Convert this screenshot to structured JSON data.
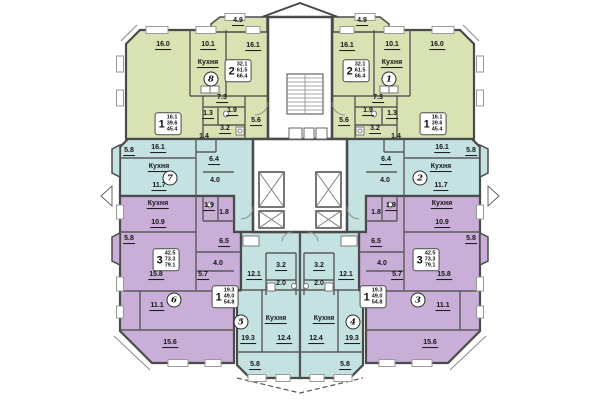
{
  "colors": {
    "apartment_green": "#d8e2b2",
    "apartment_teal": "#c4e2e2",
    "apartment_purple": "#c9aed7",
    "walls": "#4a4a4a",
    "inner_walls": "#5a5a5a",
    "background": "#ffffff"
  },
  "apartments": [
    {
      "number": "8",
      "rooms": "2",
      "living": "32.1",
      "usable": "61.5",
      "total": "66.4",
      "badge_x": 211,
      "badge_y": 79,
      "box_x": 238,
      "box_y": 71
    },
    {
      "number": "1",
      "rooms": "2",
      "living": "32.1",
      "usable": "61.5",
      "total": "66.4",
      "badge_x": 389,
      "badge_y": 79,
      "box_x": 356,
      "box_y": 71
    },
    {
      "number": "7",
      "rooms": "1",
      "living": "16.1",
      "usable": "39.6",
      "total": "45.4",
      "badge_x": 170,
      "badge_y": 178,
      "box_x": 168,
      "box_y": 124
    },
    {
      "number": "2",
      "rooms": "1",
      "living": "16.1",
      "usable": "39.6",
      "total": "45.4",
      "badge_x": 420,
      "badge_y": 178,
      "box_x": 433,
      "box_y": 124
    },
    {
      "number": "6",
      "rooms": "3",
      "living": "42.5",
      "usable": "73.3",
      "total": "79.1",
      "badge_x": 174,
      "badge_y": 300,
      "box_x": 166,
      "box_y": 260
    },
    {
      "number": "3",
      "rooms": "3",
      "living": "42.5",
      "usable": "73.3",
      "total": "79.1",
      "badge_x": 418,
      "badge_y": 300,
      "box_x": 426,
      "box_y": 260
    },
    {
      "number": "5",
      "rooms": "1",
      "living": "19.3",
      "usable": "49.0",
      "total": "54.8",
      "badge_x": 241,
      "badge_y": 322,
      "box_x": 225,
      "box_y": 297
    },
    {
      "number": "4",
      "rooms": "1",
      "living": "19.3",
      "usable": "49.0",
      "total": "54.8",
      "badge_x": 353,
      "badge_y": 322,
      "box_x": 373,
      "box_y": 297
    }
  ],
  "room_labels": [
    {
      "t": "4.9",
      "x": 238,
      "y": 22,
      "u": 1
    },
    {
      "t": "16.0",
      "x": 163,
      "y": 46,
      "u": 1
    },
    {
      "t": "10.1",
      "x": 208,
      "y": 46,
      "u": 1
    },
    {
      "t": "16.1",
      "x": 253,
      "y": 47,
      "u": 1
    },
    {
      "t": "Кухня",
      "x": 208,
      "y": 64,
      "u": 1
    },
    {
      "t": "7.3",
      "x": 222,
      "y": 99,
      "u": 1
    },
    {
      "t": "1.3",
      "x": 208,
      "y": 115,
      "u": 1
    },
    {
      "t": "1.9",
      "x": 232,
      "y": 112,
      "u": 1
    },
    {
      "t": "3.2",
      "x": 225,
      "y": 130,
      "u": 1
    },
    {
      "t": "5.6",
      "x": 256,
      "y": 122,
      "u": 1
    },
    {
      "t": "1.4",
      "x": 204,
      "y": 137,
      "u": 0
    },
    {
      "t": "4.9",
      "x": 362,
      "y": 22,
      "u": 1
    },
    {
      "t": "16.1",
      "x": 347,
      "y": 47,
      "u": 1
    },
    {
      "t": "10.1",
      "x": 392,
      "y": 46,
      "u": 1
    },
    {
      "t": "16.0",
      "x": 437,
      "y": 46,
      "u": 1
    },
    {
      "t": "Кухня",
      "x": 392,
      "y": 64,
      "u": 1
    },
    {
      "t": "7.3",
      "x": 378,
      "y": 99,
      "u": 1
    },
    {
      "t": "1.9",
      "x": 368,
      "y": 112,
      "u": 1
    },
    {
      "t": "1.3",
      "x": 392,
      "y": 115,
      "u": 1
    },
    {
      "t": "3.2",
      "x": 375,
      "y": 130,
      "u": 1
    },
    {
      "t": "5.6",
      "x": 344,
      "y": 122,
      "u": 1
    },
    {
      "t": "1.4",
      "x": 396,
      "y": 137,
      "u": 0
    },
    {
      "t": "5.8",
      "x": 129,
      "y": 152,
      "u": 1
    },
    {
      "t": "16.1",
      "x": 158,
      "y": 149,
      "u": 1
    },
    {
      "t": "Кухня",
      "x": 159,
      "y": 168,
      "u": 1
    },
    {
      "t": "11.7",
      "x": 159,
      "y": 187,
      "u": 1
    },
    {
      "t": "6.4",
      "x": 214,
      "y": 161,
      "u": 1
    },
    {
      "t": "4.0",
      "x": 215,
      "y": 181,
      "u": 0
    },
    {
      "t": "5.8",
      "x": 471,
      "y": 152,
      "u": 1
    },
    {
      "t": "16.1",
      "x": 442,
      "y": 149,
      "u": 1
    },
    {
      "t": "Кухня",
      "x": 441,
      "y": 168,
      "u": 1
    },
    {
      "t": "11.7",
      "x": 441,
      "y": 187,
      "u": 1
    },
    {
      "t": "6.4",
      "x": 386,
      "y": 161,
      "u": 1
    },
    {
      "t": "4.0",
      "x": 385,
      "y": 181,
      "u": 0
    },
    {
      "t": "Кухня",
      "x": 158,
      "y": 205,
      "u": 1
    },
    {
      "t": "1.9",
      "x": 209,
      "y": 207,
      "u": 1
    },
    {
      "t": "1.8",
      "x": 224,
      "y": 213,
      "u": 0
    },
    {
      "t": "10.9",
      "x": 158,
      "y": 224,
      "u": 1
    },
    {
      "t": "5.8",
      "x": 129,
      "y": 240,
      "u": 1
    },
    {
      "t": "6.5",
      "x": 224,
      "y": 243,
      "u": 1
    },
    {
      "t": "4.0",
      "x": 218,
      "y": 264,
      "u": 0
    },
    {
      "t": "5.7",
      "x": 203,
      "y": 276,
      "u": 1
    },
    {
      "t": "15.8",
      "x": 156,
      "y": 276,
      "u": 1
    },
    {
      "t": "11.1",
      "x": 157,
      "y": 307,
      "u": 1
    },
    {
      "t": "15.6",
      "x": 170,
      "y": 344,
      "u": 1
    },
    {
      "t": "Кухня",
      "x": 442,
      "y": 205,
      "u": 1
    },
    {
      "t": "1.9",
      "x": 391,
      "y": 207,
      "u": 1
    },
    {
      "t": "1.8",
      "x": 376,
      "y": 213,
      "u": 0
    },
    {
      "t": "10.9",
      "x": 442,
      "y": 224,
      "u": 1
    },
    {
      "t": "5.8",
      "x": 471,
      "y": 240,
      "u": 1
    },
    {
      "t": "6.5",
      "x": 376,
      "y": 243,
      "u": 1
    },
    {
      "t": "4.0",
      "x": 382,
      "y": 264,
      "u": 0
    },
    {
      "t": "5.7",
      "x": 397,
      "y": 276,
      "u": 1
    },
    {
      "t": "15.8",
      "x": 444,
      "y": 276,
      "u": 1
    },
    {
      "t": "11.1",
      "x": 443,
      "y": 307,
      "u": 1
    },
    {
      "t": "15.6",
      "x": 430,
      "y": 344,
      "u": 1
    },
    {
      "t": "12.1",
      "x": 254,
      "y": 276,
      "u": 1
    },
    {
      "t": "3.2",
      "x": 281,
      "y": 267,
      "u": 1
    },
    {
      "t": "2.0",
      "x": 281,
      "y": 284,
      "u": 0
    },
    {
      "t": "19.3",
      "x": 248,
      "y": 340,
      "u": 1
    },
    {
      "t": "Кухня",
      "x": 276,
      "y": 320,
      "u": 1
    },
    {
      "t": "12.4",
      "x": 284,
      "y": 340,
      "u": 1
    },
    {
      "t": "5.8",
      "x": 255,
      "y": 366,
      "u": 1
    },
    {
      "t": "12.1",
      "x": 346,
      "y": 276,
      "u": 1
    },
    {
      "t": "3.2",
      "x": 319,
      "y": 267,
      "u": 1
    },
    {
      "t": "2.0",
      "x": 319,
      "y": 284,
      "u": 0
    },
    {
      "t": "19.3",
      "x": 352,
      "y": 340,
      "u": 1
    },
    {
      "t": "Кухня",
      "x": 324,
      "y": 320,
      "u": 1
    },
    {
      "t": "12.4",
      "x": 316,
      "y": 340,
      "u": 1
    },
    {
      "t": "5.8",
      "x": 345,
      "y": 366,
      "u": 1
    }
  ]
}
